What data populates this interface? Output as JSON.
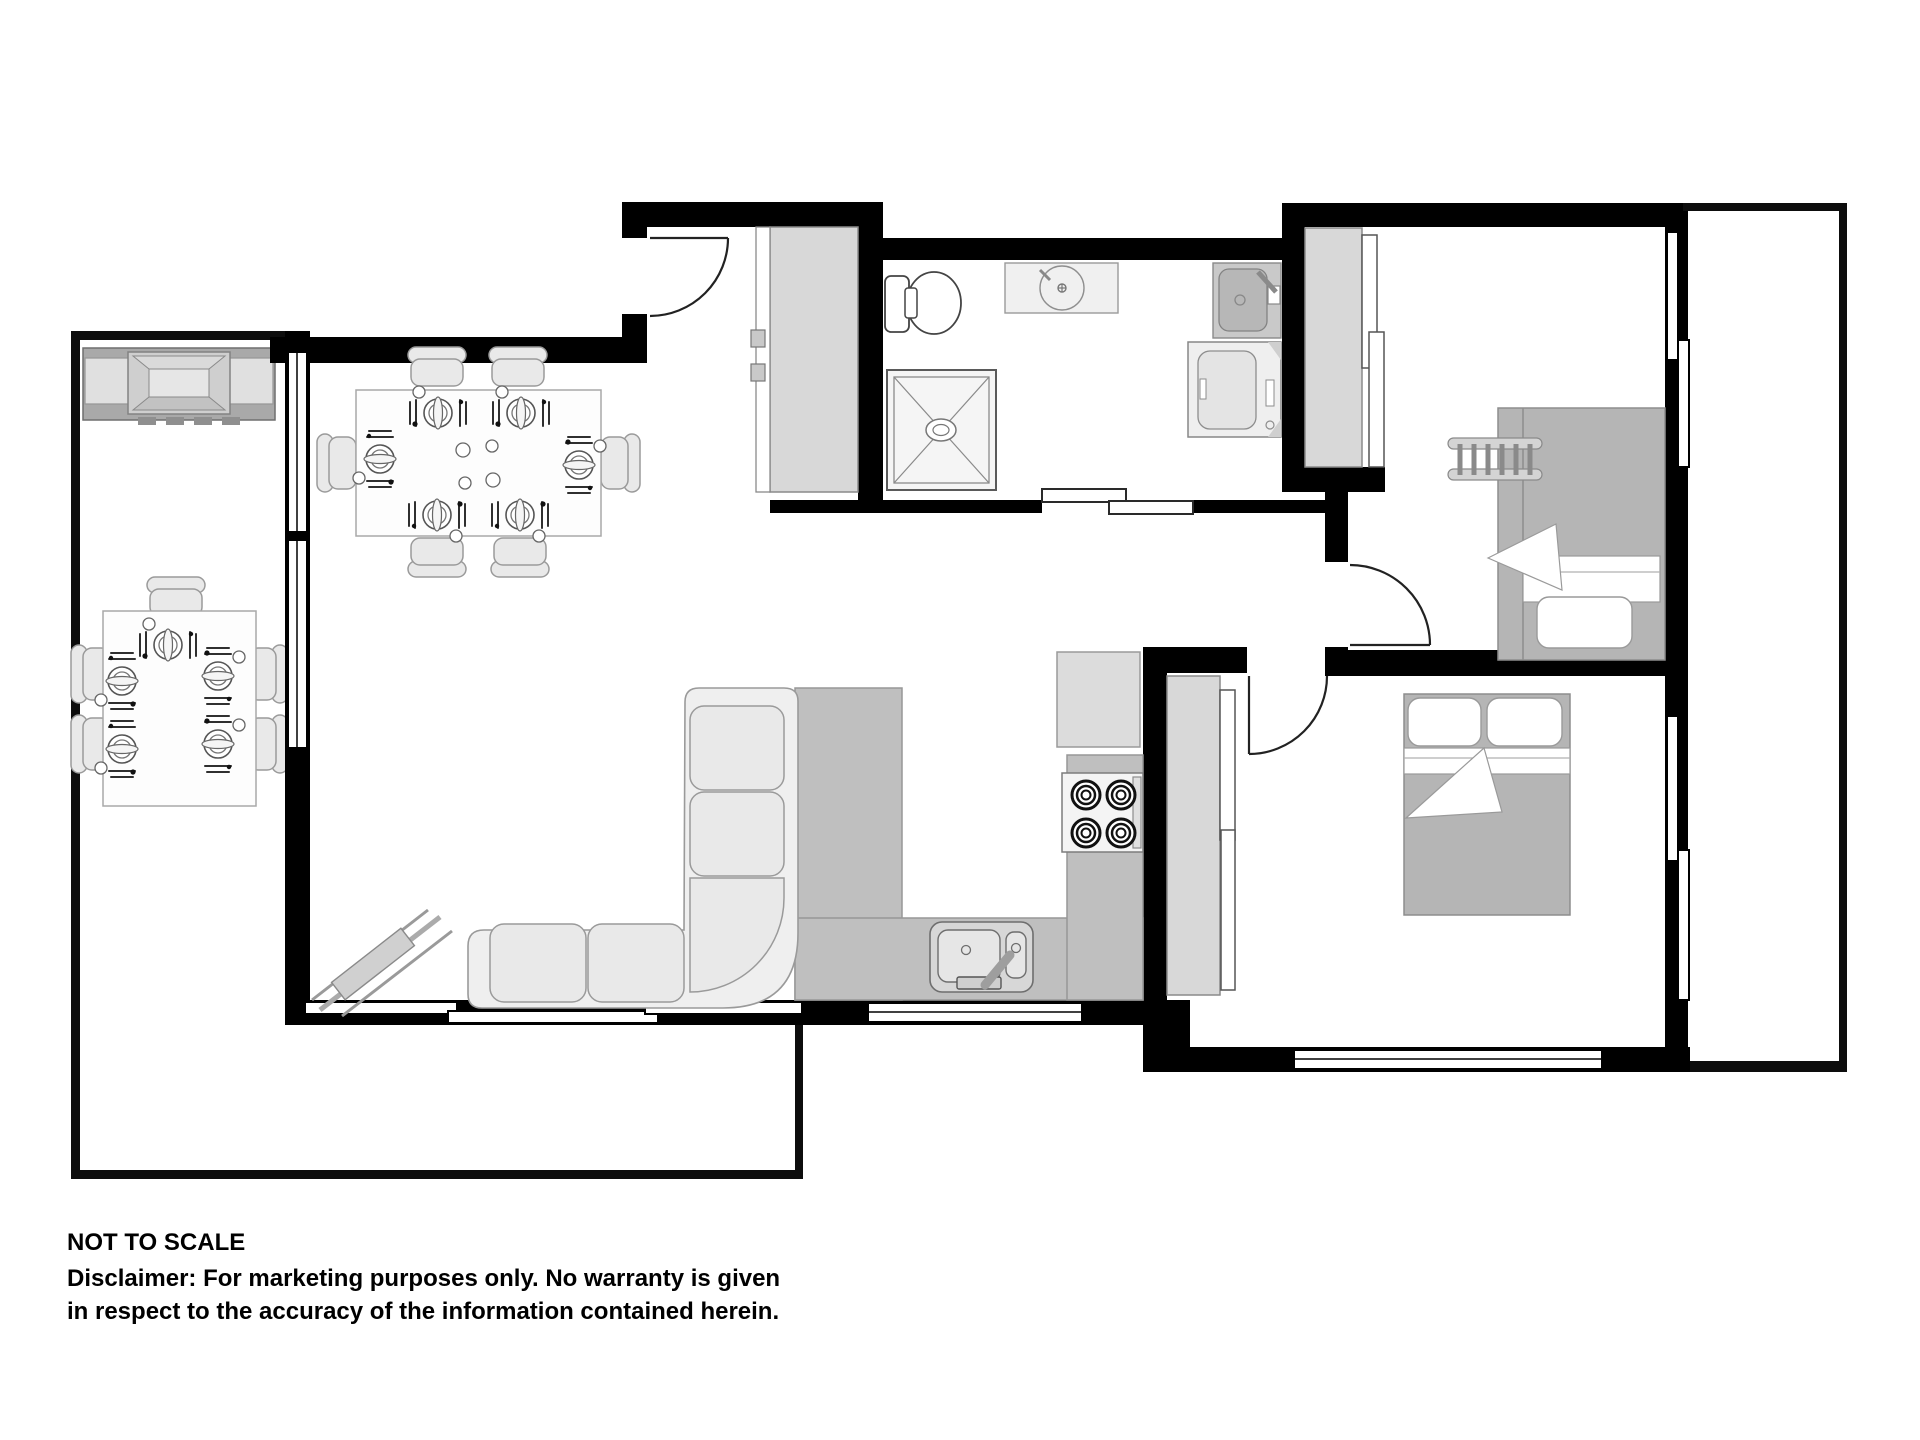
{
  "page": {
    "type": "architectural floor plan",
    "background": "#ffffff"
  },
  "labels": {
    "scale_note": "NOT TO SCALE",
    "disclaimer_line1": "Disclaimer: For marketing purposes only.  No warranty is given",
    "disclaimer_line2": "in respect to the accuracy of the information contained herein."
  },
  "colors": {
    "wall": "#000000",
    "outline": "#0d0d0d",
    "furniture_light": "#e9e9e9",
    "furniture_outline": "#9a9a9a",
    "kitchen_bench": "#bfbfbf",
    "bed_gray": "#b5b5b5",
    "wardrobe_gray": "#d8d8d8",
    "appliance_gray": "#dcdcdc",
    "fixture_white": "#f4f4f4"
  },
  "rooms": [
    {
      "name": "deck",
      "fixtures": [
        "bbq-grill",
        "outdoor-dining-table",
        "five-outdoor-chairs",
        "five-place-settings"
      ]
    },
    {
      "name": "dining-area",
      "fixtures": [
        "dining-table",
        "six-chairs",
        "six-place-settings",
        "serving-dishes"
      ]
    },
    {
      "name": "living-area",
      "fixtures": [
        "l-shaped-sofa",
        "corner-tv-unit",
        "windows"
      ]
    },
    {
      "name": "kitchen",
      "fixtures": [
        "u-shaped-bench",
        "double-bowl-sink",
        "four-burner-cooktop",
        "fridge",
        "window"
      ]
    },
    {
      "name": "entry",
      "fixtures": [
        "hinged-entry-door",
        "built-in-wardrobe"
      ]
    },
    {
      "name": "bathroom-laundry",
      "fixtures": [
        "toilet",
        "vanity-basin",
        "laundry-trough",
        "washing-machine",
        "shower",
        "cavity-sliding-door"
      ]
    },
    {
      "name": "bedroom-1",
      "fixtures": [
        "bunk-bed",
        "bunk-ladder",
        "built-in-wardrobe",
        "window",
        "hinged-door"
      ]
    },
    {
      "name": "bedroom-2",
      "fixtures": [
        "double-bed",
        "built-in-robe",
        "windows",
        "hinged-door"
      ]
    },
    {
      "name": "side-courtyard",
      "fixtures": []
    }
  ]
}
